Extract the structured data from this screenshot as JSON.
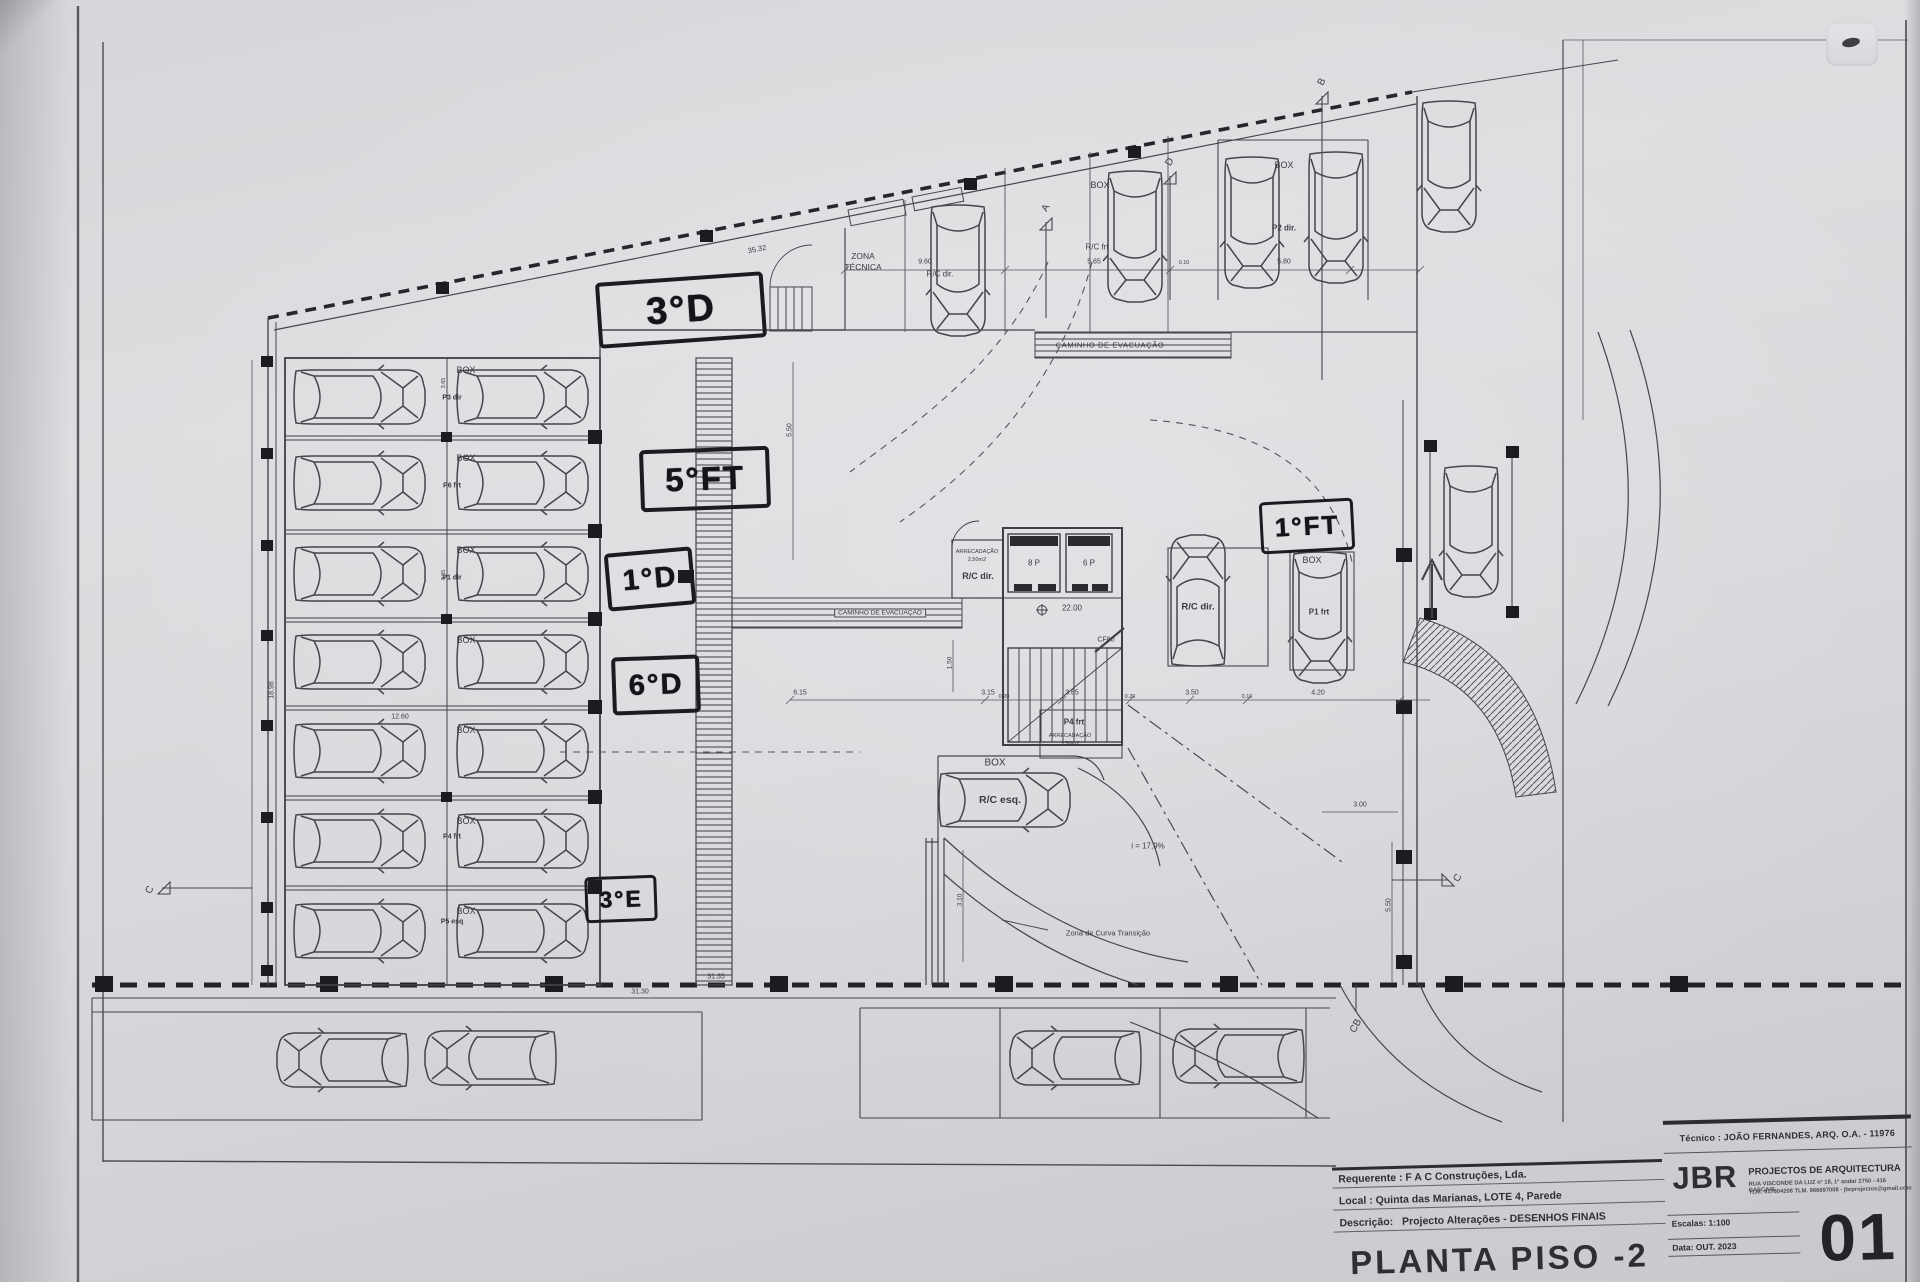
{
  "colors": {
    "paper": "#d9d8db",
    "ink": "#3a3a41",
    "marker": "#17171c",
    "dash": "#26262c"
  },
  "plan": {
    "grid": {
      "a": "A",
      "d": "D",
      "b": "B",
      "c": "C",
      "cb": "CB"
    },
    "labels": {
      "zona1": "ZONA",
      "zona2": "TÉCNICA",
      "caminho": "CAMINHO DE EVACUAÇÃO",
      "box": "BOX",
      "p3dir": "P3 dir",
      "p6frt": "P6 frt",
      "p1dir": "P1 dir",
      "p4frt": "P4 frt",
      "p5esq": "P5 esq",
      "rcfrt": "R/C frt",
      "p2dir": "P2 dir.",
      "rcdir": "R/C dir.",
      "rcesq": "R/C esq.",
      "p1frt": "P1 frt",
      "arrecadacao": "ARRECADAÇÃO",
      "a250": "2,50m2",
      "a350": "3,50m2",
      "lift8": "8 P",
      "lift6": "6 P",
      "cf60": "CF60",
      "level": "22.00",
      "slope": "i = 17,9%",
      "curva": "Zona de Curva Transição"
    },
    "dims": {
      "d3532": "35.32",
      "d960": "9.60",
      "d565": "5.65",
      "d010": "0.10",
      "d580": "5.80",
      "d615": "6.15",
      "d315": "3.15",
      "d020": "0.20",
      "d365": "3.65",
      "d350": "3.50",
      "d420": "4.20",
      "d300": "3.00",
      "d550": "5.50",
      "d150": "1.50",
      "d310": "3.10",
      "d1260": "12.60",
      "d1898": "18.98",
      "d3130": "31.30",
      "d3135": "31.35",
      "d305": "3.05"
    }
  },
  "annotations": {
    "a1": "3°D",
    "a2": "5°FT",
    "a3": "1°D",
    "a4": "6°D",
    "a5": "3°E",
    "a6": "1°FT"
  },
  "title_block": {
    "technician": "Técnico : JOÃO FERNANDES, ARQ.   O.A. - 11976",
    "firm_name": "JBR",
    "firm_suffix": "PROJECTOS DE ARQUITECTURA",
    "firm_address": "RUA VISCONDE DA LUZ nº 18, 1º andar  2750 - 416 CASCAIS",
    "firm_contacts": "TLM. 917804208  TLM. 966697008 - jbrprojectos@gmail.com",
    "requester": "Requerente : F A C  Construções, Lda.",
    "location": "Local : Quinta das Marianas, LOTE 4, Parede",
    "description_label": "Descrição:",
    "description": "Projecto Alterações - DESENHOS FINAIS",
    "drawing_title": "PLANTA PISO -2",
    "scale": "Escalas: 1:100",
    "date": "Data: OUT. 2023",
    "sheet_number": "01"
  }
}
